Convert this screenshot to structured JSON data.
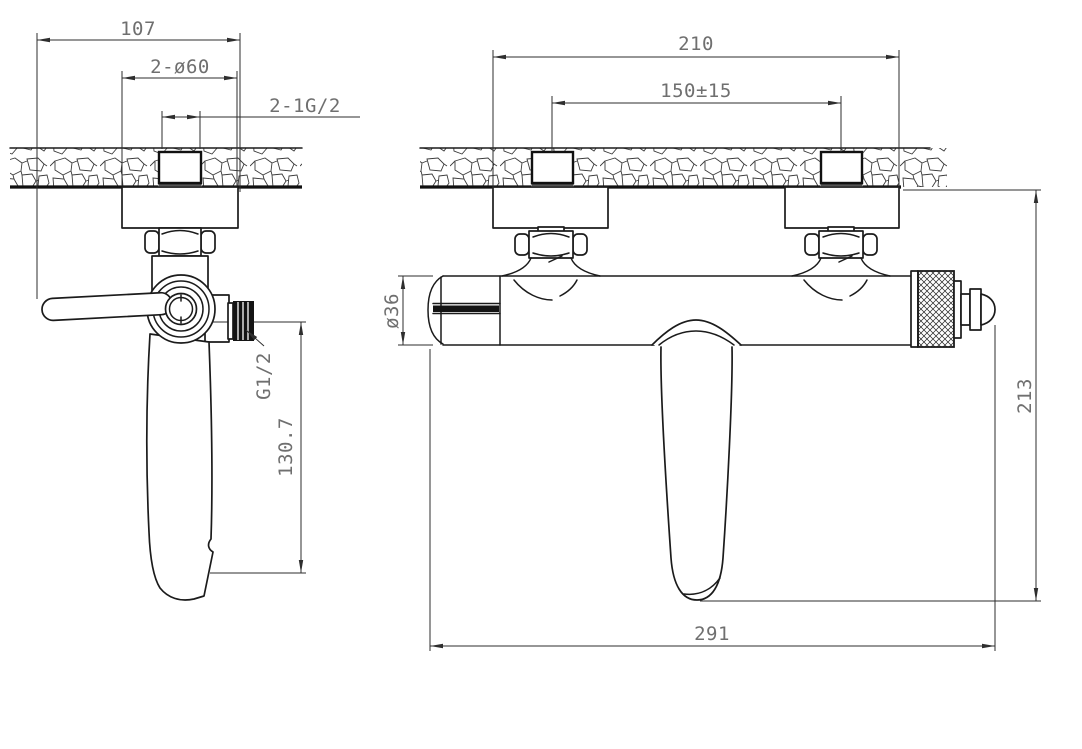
{
  "drawing": {
    "side_view": {
      "dim_depth": "107",
      "dim_escutcheon": "2-ø60",
      "dim_inlet_thread": "2-1G/2",
      "label_outlet_thread": "G1/2",
      "dim_spout_drop": "130.7"
    },
    "front_view": {
      "dim_span": "210",
      "dim_centers": "150±15",
      "label_diameter": "ø36",
      "dim_height": "213",
      "dim_length": "291"
    },
    "colors": {
      "line": "#1b1b1b",
      "dim_line": "#2e2e2e",
      "text": "#6f6f6f",
      "background": "#ffffff"
    }
  }
}
